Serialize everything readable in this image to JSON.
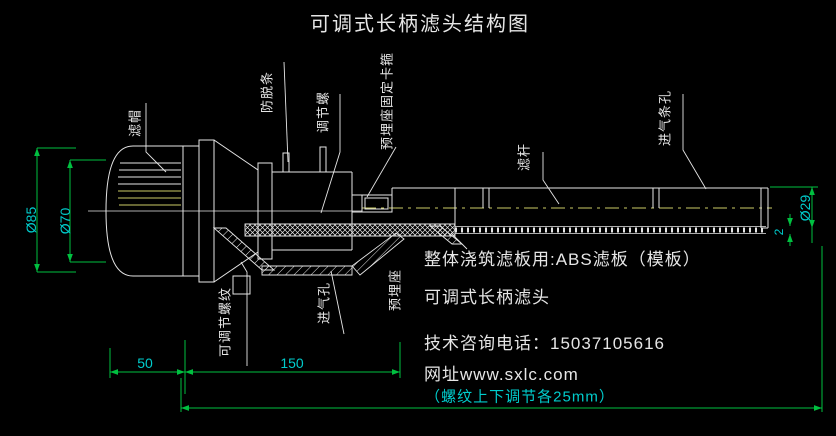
{
  "title": "可调式长柄滤头结构图",
  "part_labels": {
    "filter_cap": "滤帽",
    "anti_slip_strip": "防脱条",
    "adjust_screw": "调节螺",
    "embedded_seat_clamp": "预埋座固定卡箍",
    "filter_rod": "滤杆",
    "air_inlet_strip_holes": "进气条孔",
    "adjustable_thread": "可调节螺纹",
    "air_inlet_hole": "进气孔",
    "embedded_seat": "预埋座"
  },
  "dimensions": {
    "outer_diameter": "Ø85",
    "inner_diameter": "Ø70",
    "rod_diameter": "Ø29",
    "plate_thickness": "2",
    "head_length": "50",
    "thread_length": "150",
    "bottom_note": "（螺纹上下调节各25mm）"
  },
  "notes": {
    "line1": "整体浇筑滤板用:ABS滤板（模板）",
    "line2": "可调式长柄滤头",
    "line3": "技术咨询电话：15037105616",
    "line4": "网址www.sxlc.com"
  },
  "colors": {
    "background": "#000000",
    "line_white": "#e6e6e6",
    "line_yellow": "#cccc66",
    "dimension_green": "#00c040",
    "text_cyan": "#00cccc"
  }
}
